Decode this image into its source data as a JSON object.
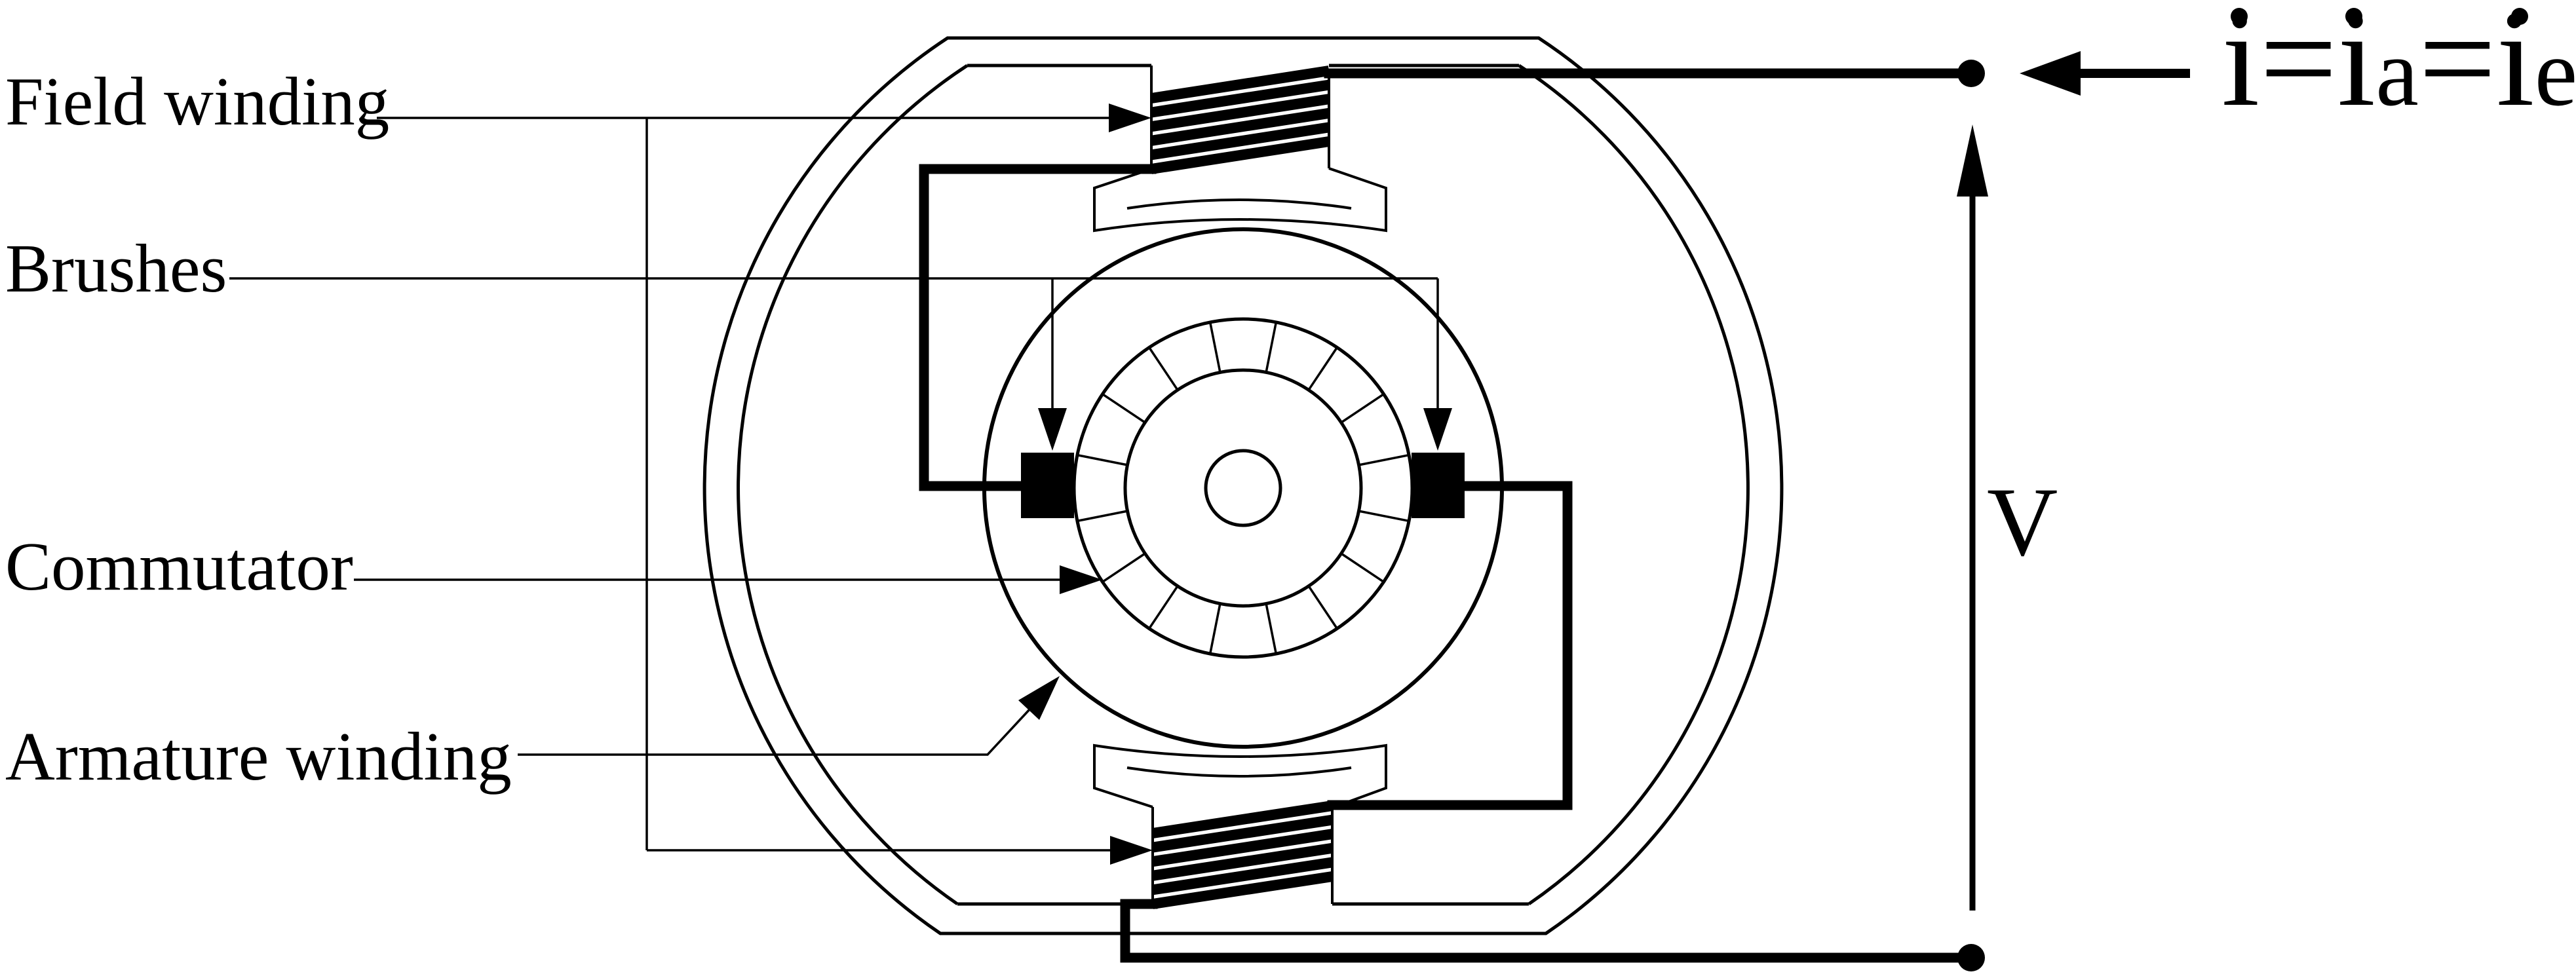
{
  "diagram_type": "dc-series-motor-cross-section",
  "colors": {
    "ink": "#000000",
    "background": "#ffffff"
  },
  "labels": {
    "field_winding": "Field winding",
    "brushes": "Brushes",
    "commutator": "Commutator",
    "armature_winding": "Armature winding"
  },
  "equation": {
    "full": "i=ia=ie",
    "i1": "i",
    "eq1": "=",
    "i2": "i",
    "sub_a": "a",
    "eq2": "=",
    "i3": "i",
    "sub_e": "e"
  },
  "voltage_label": "V",
  "components": {
    "field_coils": 2,
    "brushes": 2,
    "commutator_segments": 16,
    "terminals": 2
  }
}
